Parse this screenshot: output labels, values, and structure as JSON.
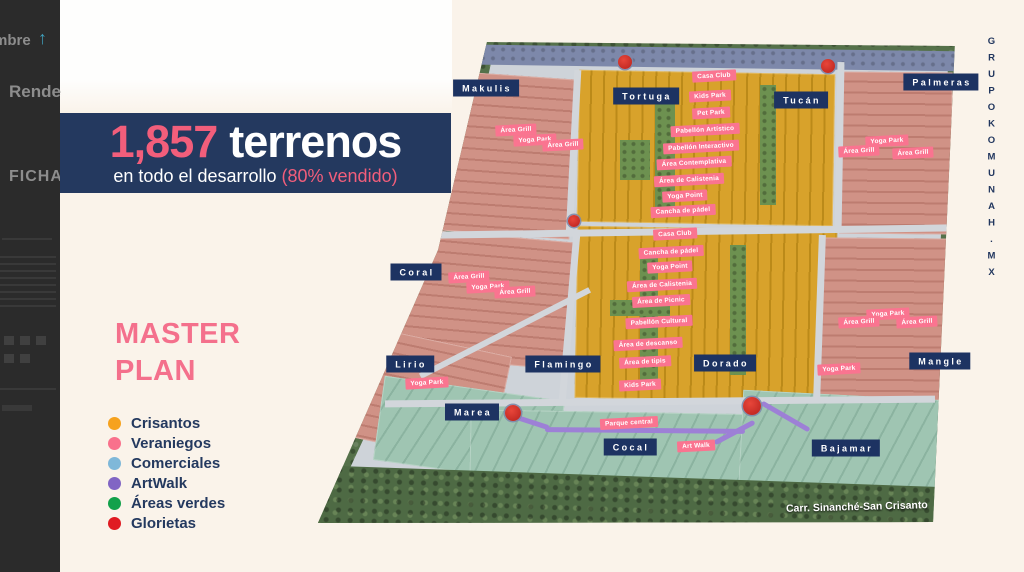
{
  "left_panel": {
    "sort_label": "mbre",
    "arrow_icon": "up-arrow",
    "item1": "Rende",
    "item2": "FICHA"
  },
  "banner": {
    "count": "1,857",
    "unit": "terrenos",
    "subtitle_prefix": "en todo el desarrollo ",
    "subtitle_highlight": "(80% vendido)"
  },
  "master_plan": {
    "title_line1": "MASTER",
    "title_line2": "PLAN"
  },
  "legend": {
    "items": [
      {
        "label": "Crisantos",
        "color": "#f6a21e"
      },
      {
        "label": "Veraniegos",
        "color": "#f9718c"
      },
      {
        "label": "Comerciales",
        "color": "#7fb8d9"
      },
      {
        "label": "ArtWalk",
        "color": "#8165c4"
      },
      {
        "label": "Áreas verdes",
        "color": "#12a14b"
      },
      {
        "label": "Glorietas",
        "color": "#e01b22"
      }
    ]
  },
  "brand": {
    "vertical_text": "GRUPOKOMUNAH.MX"
  },
  "map": {
    "road_label": "Carr. Sinanché-San Crisanto",
    "district_labels": [
      {
        "label": "Makulis",
        "x": 486,
        "y": 88
      },
      {
        "label": "Tortuga",
        "x": 646,
        "y": 96
      },
      {
        "label": "Tucán",
        "x": 801,
        "y": 100
      },
      {
        "label": "Palmeras",
        "x": 941,
        "y": 82
      },
      {
        "label": "Coral",
        "x": 416,
        "y": 272
      },
      {
        "label": "Lirio",
        "x": 410,
        "y": 364
      },
      {
        "label": "Flamingo",
        "x": 563,
        "y": 364
      },
      {
        "label": "Dorado",
        "x": 725,
        "y": 363
      },
      {
        "label": "Mangle",
        "x": 940,
        "y": 361
      },
      {
        "label": "Marea",
        "x": 472,
        "y": 412
      },
      {
        "label": "Cocal",
        "x": 630,
        "y": 447
      },
      {
        "label": "Bajamar",
        "x": 846,
        "y": 448
      }
    ],
    "amenity_labels": [
      {
        "label": "Área Grill",
        "x": 516,
        "y": 130
      },
      {
        "label": "Yoga Park",
        "x": 535,
        "y": 140
      },
      {
        "label": "Área Grill",
        "x": 563,
        "y": 145
      },
      {
        "label": "Casa Club",
        "x": 714,
        "y": 76
      },
      {
        "label": "Kids Park",
        "x": 710,
        "y": 96
      },
      {
        "label": "Pet Park",
        "x": 711,
        "y": 113
      },
      {
        "label": "Pabellón Artístico",
        "x": 705,
        "y": 130
      },
      {
        "label": "Pabellón Interactivo",
        "x": 701,
        "y": 147
      },
      {
        "label": "Área Contemplativa",
        "x": 694,
        "y": 163
      },
      {
        "label": "Área de Calistenia",
        "x": 689,
        "y": 180
      },
      {
        "label": "Yoga Point",
        "x": 685,
        "y": 196
      },
      {
        "label": "Cancha de pádel",
        "x": 683,
        "y": 211
      },
      {
        "label": "Casa Club",
        "x": 675,
        "y": 234
      },
      {
        "label": "Cancha de pádel",
        "x": 671,
        "y": 252
      },
      {
        "label": "Yoga Point",
        "x": 670,
        "y": 267
      },
      {
        "label": "Área de Calistenia",
        "x": 662,
        "y": 285
      },
      {
        "label": "Área de Picnic",
        "x": 661,
        "y": 301
      },
      {
        "label": "Pabellón Cultural",
        "x": 659,
        "y": 322
      },
      {
        "label": "Área de descanso",
        "x": 648,
        "y": 344
      },
      {
        "label": "Área de tipis",
        "x": 645,
        "y": 362
      },
      {
        "label": "Kids Park",
        "x": 640,
        "y": 385
      },
      {
        "label": "Área Grill",
        "x": 469,
        "y": 277
      },
      {
        "label": "Yoga Park",
        "x": 488,
        "y": 287
      },
      {
        "label": "Área Grill",
        "x": 515,
        "y": 292
      },
      {
        "label": "Yoga Park",
        "x": 427,
        "y": 383
      },
      {
        "label": "Yoga Park",
        "x": 887,
        "y": 141
      },
      {
        "label": "Área Grill",
        "x": 859,
        "y": 151
      },
      {
        "label": "Área Grill",
        "x": 913,
        "y": 153
      },
      {
        "label": "Yoga Park",
        "x": 888,
        "y": 314
      },
      {
        "label": "Área Grill",
        "x": 859,
        "y": 322
      },
      {
        "label": "Área Grill",
        "x": 917,
        "y": 322
      },
      {
        "label": "Yoga Park",
        "x": 839,
        "y": 369
      },
      {
        "label": "Parque central",
        "x": 629,
        "y": 423
      },
      {
        "label": "Art Walk",
        "x": 696,
        "y": 446
      }
    ],
    "glorietas": [
      {
        "x": 625,
        "y": 62,
        "r": 7
      },
      {
        "x": 828,
        "y": 66,
        "r": 7
      },
      {
        "x": 574,
        "y": 221,
        "r": 6
      },
      {
        "x": 513,
        "y": 413,
        "r": 8
      },
      {
        "x": 752,
        "y": 406,
        "r": 9
      }
    ]
  }
}
